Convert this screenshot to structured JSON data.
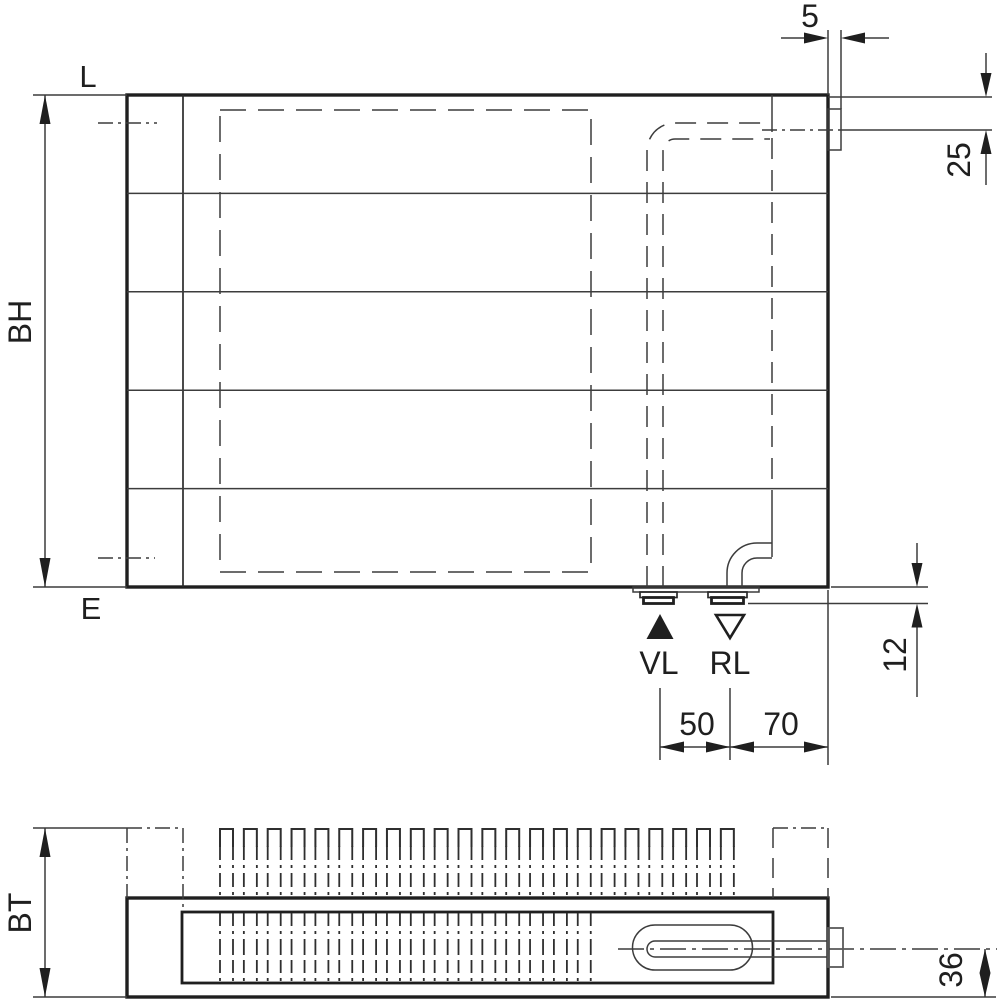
{
  "labels": {
    "connection_top": "L",
    "connection_bottom": "E",
    "build_height": "BH",
    "build_depth": "BT",
    "supply": "VL",
    "return": "RL"
  },
  "dimensions": {
    "bracket_width": "5",
    "top_to_side_connection": "25",
    "connection_protrusion": "12",
    "supply_return_spacing": "50",
    "return_to_edge": "70",
    "pipe_center_to_front": "36"
  },
  "colors": {
    "line": "#2b2b2b",
    "background": "#ffffff"
  }
}
